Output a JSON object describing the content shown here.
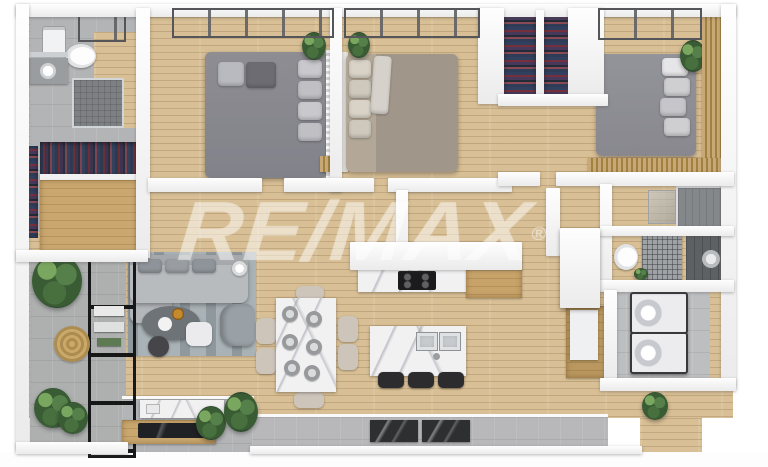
{
  "scene": {
    "description": "3D rendered top-down floor plan of a three-bedroom apartment",
    "watermark": {
      "brand": "RE/MAX",
      "registered_symbol": "®"
    }
  },
  "palette": {
    "wood_floor": "#d8bf95",
    "wall_white": "#f4f4f4",
    "tile_gray": "#b3b4b6",
    "window_dark": "#242527",
    "bed_gray": "#87878c",
    "bed_taupe": "#a79c8d",
    "sofa_gray": "#b4b7ba",
    "rug_gray": "#a9b2b6",
    "plant_green": "#3f6339",
    "marble_white": "#f2f1f2",
    "cabinet_wood": "#c9a76f",
    "glass_partition": "#3c4247",
    "watermark_white": "rgba(255,255,255,0.43)"
  },
  "rooms": [
    {
      "name": "ensuite-bathroom"
    },
    {
      "name": "walk-in-closet"
    },
    {
      "name": "bedroom-1"
    },
    {
      "name": "bedroom-2"
    },
    {
      "name": "bedroom-3"
    },
    {
      "name": "wardrobe-closets"
    },
    {
      "name": "shower-room"
    },
    {
      "name": "wc-vanity-room"
    },
    {
      "name": "laundry-closet"
    },
    {
      "name": "hallway"
    },
    {
      "name": "kitchen"
    },
    {
      "name": "dining-area"
    },
    {
      "name": "living-room"
    },
    {
      "name": "balcony-garden"
    },
    {
      "name": "terrace"
    }
  ],
  "furniture": [
    "double-bed-gray",
    "double-bed-taupe",
    "double-bed-gray-2",
    "sofa",
    "armchair",
    "coffee-table",
    "pouf",
    "side-table",
    "area-rug",
    "dining-table-marble",
    "dining-chairs-x6",
    "kitchen-island",
    "bar-stools-x3",
    "gas-stove",
    "double-sink",
    "kitchen-cabinets",
    "tv-console",
    "tv",
    "washer",
    "dryer",
    "water-heater",
    "toilets-x2",
    "showers-x3",
    "clothes-racks",
    "potted-plants",
    "round-woven-rug",
    "door-mats-x2"
  ]
}
